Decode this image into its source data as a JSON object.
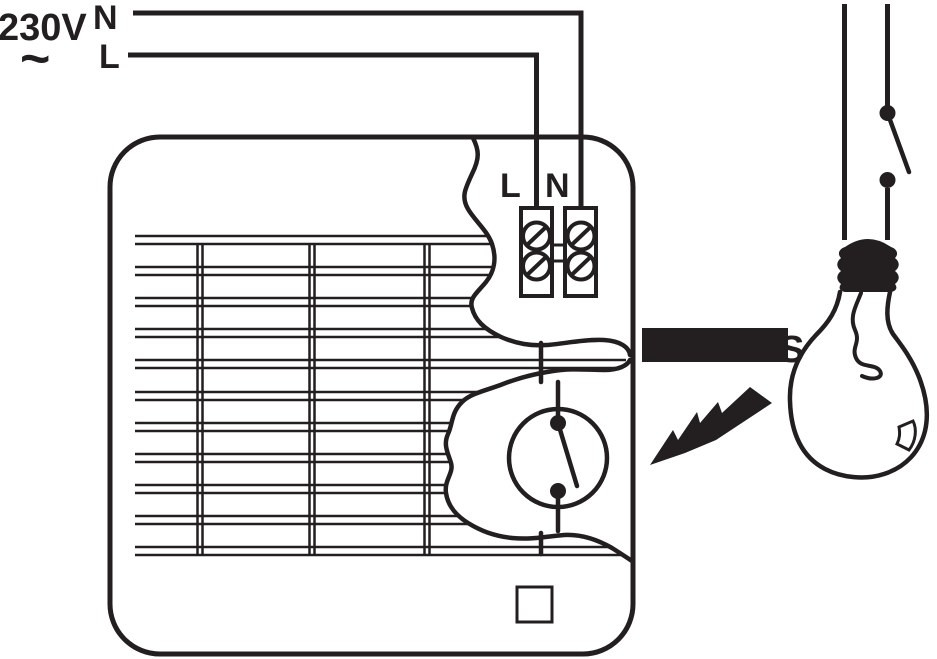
{
  "colors": {
    "ink": "#231f20",
    "paper": "#ffffff"
  },
  "supply": {
    "voltage": "230V",
    "ac_symbol": "~",
    "neutral_label": "N",
    "live_label": "L"
  },
  "fan": {
    "terminal_live_label": "L",
    "terminal_neutral_label": "N"
  },
  "annotations": {
    "switched_live_label": "S"
  }
}
